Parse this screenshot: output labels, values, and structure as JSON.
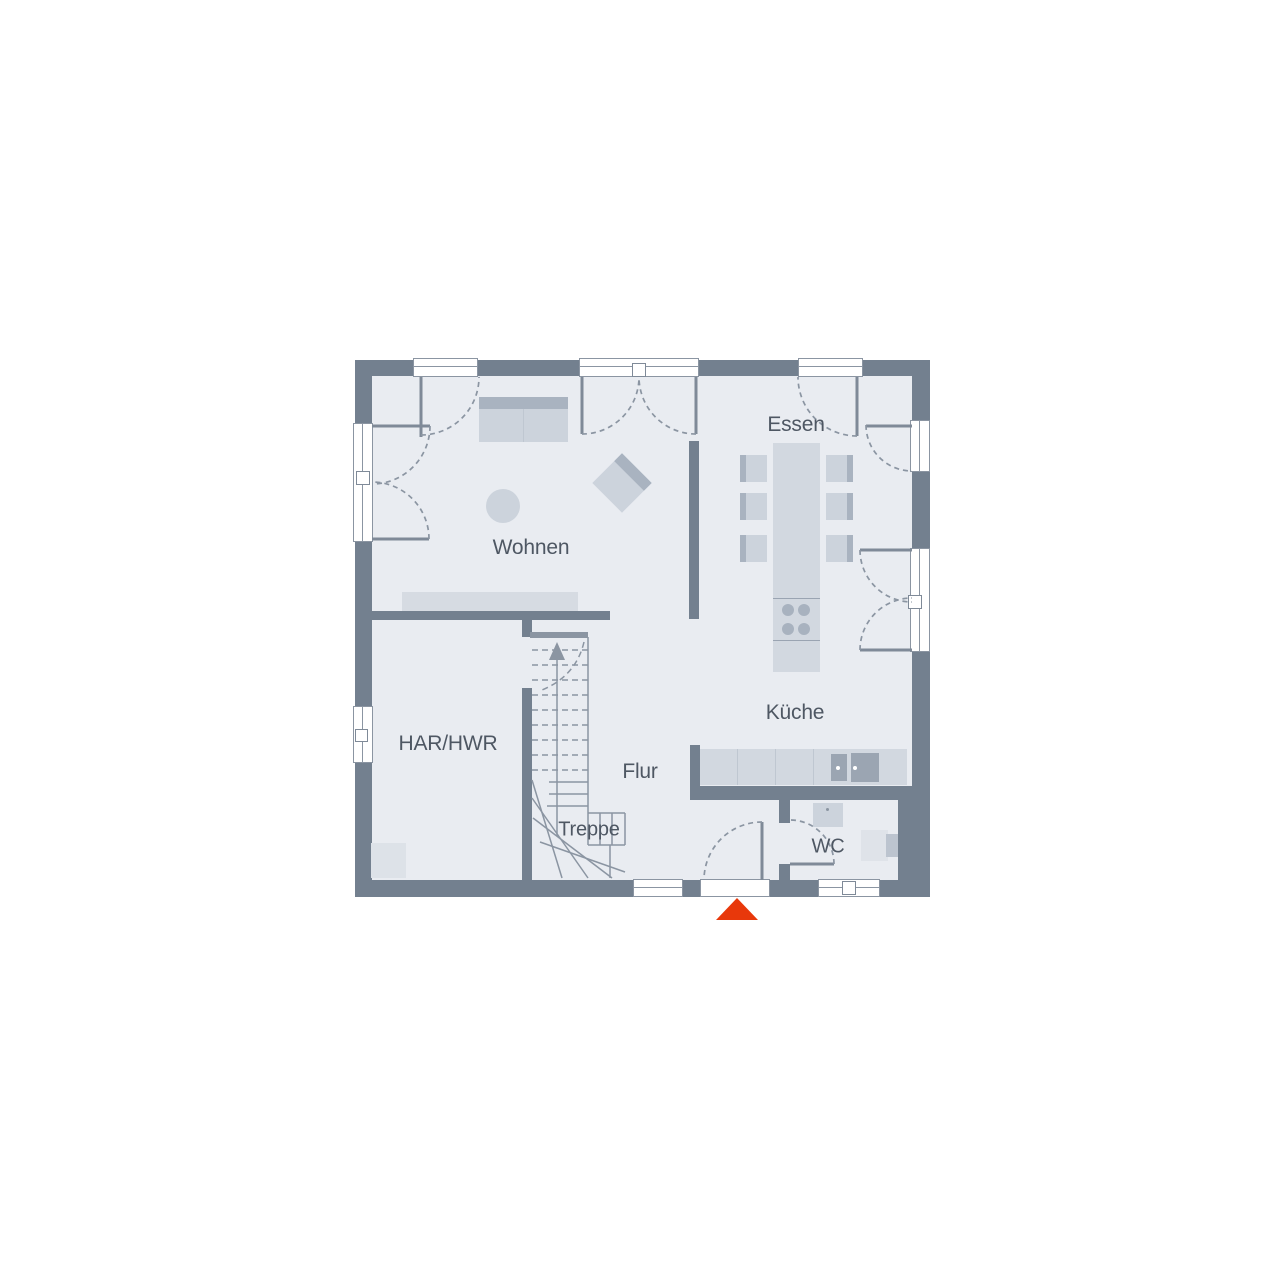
{
  "plan": {
    "title": "floor-plan",
    "rooms": {
      "wohnen": {
        "label": "Wohnen"
      },
      "essen": {
        "label": "Essen"
      },
      "kueche": {
        "label": "Küche"
      },
      "flur": {
        "label": "Flur"
      },
      "treppe": {
        "label": "Treppe"
      },
      "har_hwr": {
        "label": "HAR/HWR"
      },
      "wc": {
        "label": "WC"
      }
    },
    "markers": {
      "entrance_icon": "entrance-triangle",
      "stair_direction_icon": "arrow-up"
    },
    "colors": {
      "wall": "#73808f",
      "floor": "#e9ecf1",
      "line": "#8b95a2",
      "furniture_light": "#ccd3dc",
      "furniture_medium": "#a9b3c0",
      "accent_red": "#e8380b",
      "text": "#4e5763"
    }
  }
}
